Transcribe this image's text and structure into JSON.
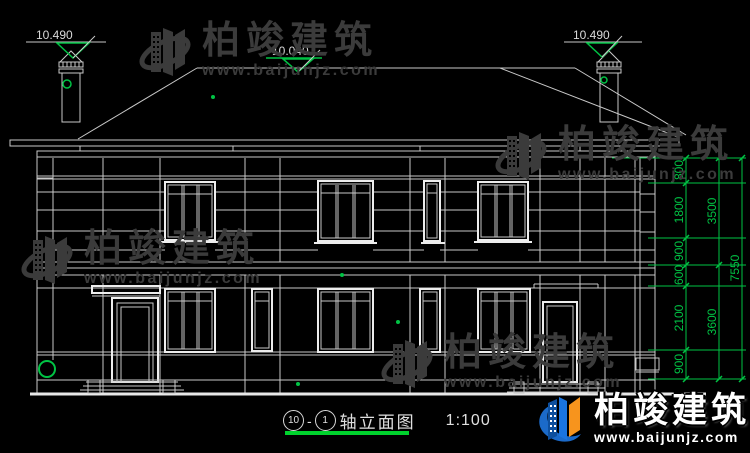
{
  "watermark": {
    "brand": "柏竣建筑",
    "url": "www.baijunjz.com"
  },
  "logo": {
    "brand": "柏竣建筑",
    "url": "www.baijunjz.com"
  },
  "markers": {
    "left": "10.490",
    "center": "10.040",
    "right": "10.490"
  },
  "dimensions": {
    "inner": [
      "800",
      "1800",
      "900",
      "600",
      "2100",
      "900"
    ],
    "middle": [
      "3500",
      "3600"
    ],
    "outer": [
      "7550"
    ]
  },
  "title": {
    "axis_start": "10",
    "separator": "-",
    "axis_end": "1",
    "name": "轴立面图",
    "scale": "1:100"
  },
  "colors": {
    "background": "#000000",
    "line": "#c9c9c9",
    "dimension_green": "#00c344",
    "underline_green": "#00d22d",
    "watermark_gray": "#3b3b3b",
    "logo_blue": "#1565c0",
    "logo_orange": "#f7941d"
  }
}
